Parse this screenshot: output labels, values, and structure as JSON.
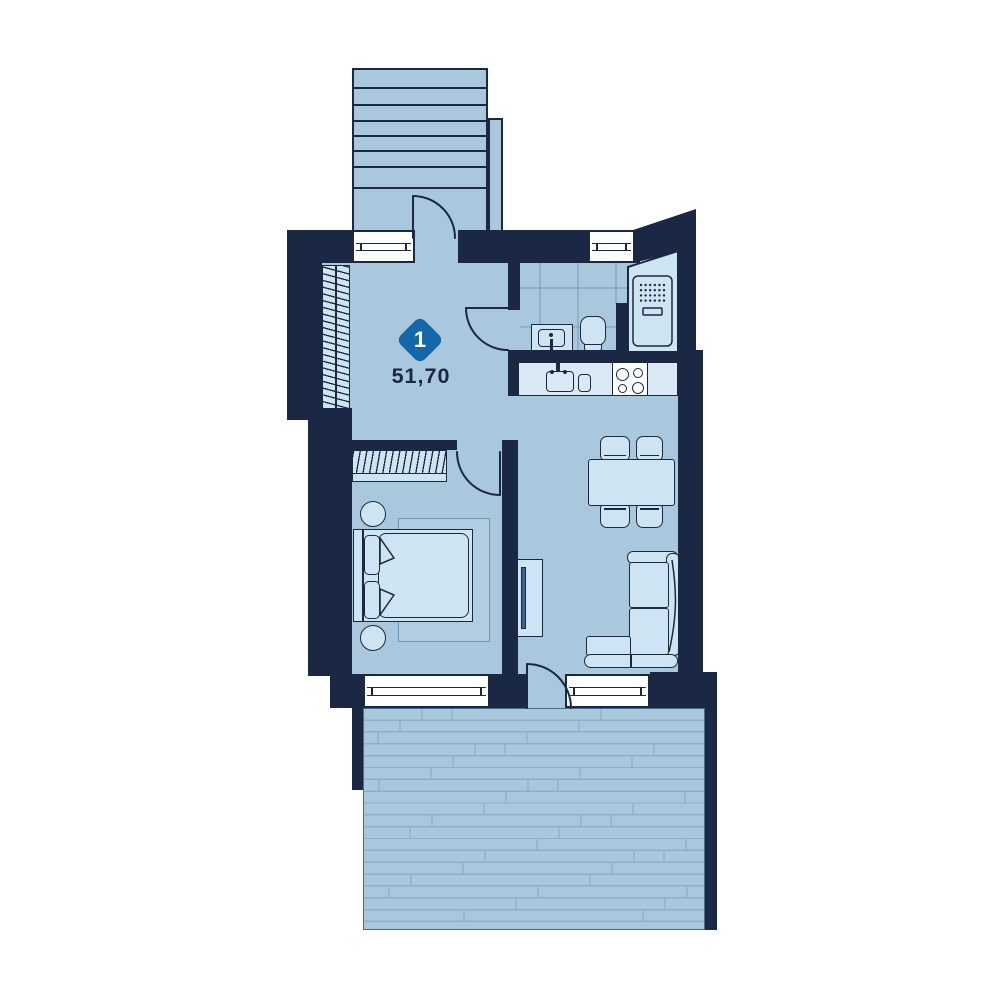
{
  "unit": {
    "marker_number": "1",
    "area_m2": "51,70"
  },
  "palette": {
    "wall": "#1b2843",
    "floor": "#a9c8dd",
    "furniture": "#cfe4f2",
    "counter": "#d9e9f5",
    "accent": "#1667a8",
    "window": "#ffffff",
    "tile_line": "#7fa2bd",
    "plank_line": "#8eafc6"
  },
  "features": [
    "staircase",
    "entrance-door",
    "hall-wardrobe",
    "bathroom-tiles",
    "washbasin",
    "toilet",
    "shower-cabinet",
    "kitchen-counter",
    "kitchen-sink",
    "stove-4-burners",
    "dining-table",
    "four-chairs",
    "corner-sofa",
    "tv-unit",
    "bedroom-wardrobe",
    "double-bed",
    "two-nightstands",
    "rug",
    "terrace-deck"
  ]
}
